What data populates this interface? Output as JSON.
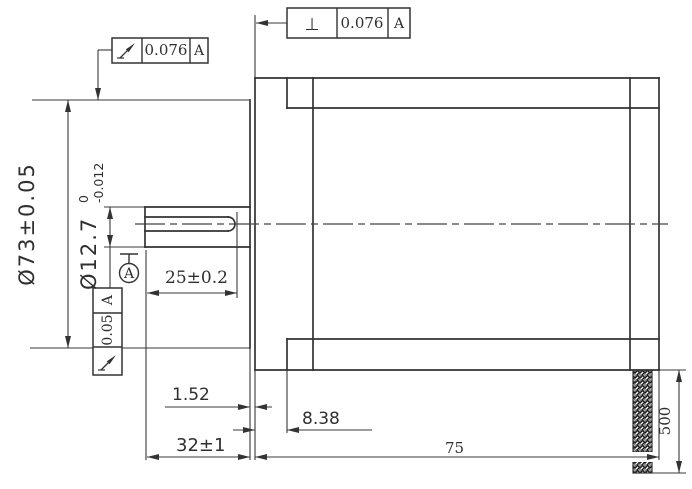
{
  "feature_controls": {
    "top": {
      "symbol": "⊥",
      "symbol_icon": "perpendicularity-icon",
      "tolerance": "0.076",
      "datum": "A"
    },
    "upper_left": {
      "symbol_icon": "circular-runout-icon",
      "tolerance": "0.076",
      "datum": "A"
    },
    "left": {
      "symbol_icon": "circular-runout-icon",
      "tolerance": "0.05",
      "datum": "A"
    }
  },
  "datum_flag": {
    "label": "A"
  },
  "dimensions": {
    "flange_diameter": "Ø73±0.05",
    "shaft_diameter": "Ø12.7",
    "shaft_diameter_upper_tol": "0",
    "shaft_diameter_lower_tol": "-0.012",
    "flat_length": "25±0.2",
    "boss_protrusion": "1.52",
    "flange_thickness": "8.38",
    "shaft_length": "32±1",
    "body_length": "75",
    "lead_length": "500"
  },
  "colors": {
    "line": "#333333",
    "background": "#ffffff",
    "hatch": "#1a1a1a"
  }
}
